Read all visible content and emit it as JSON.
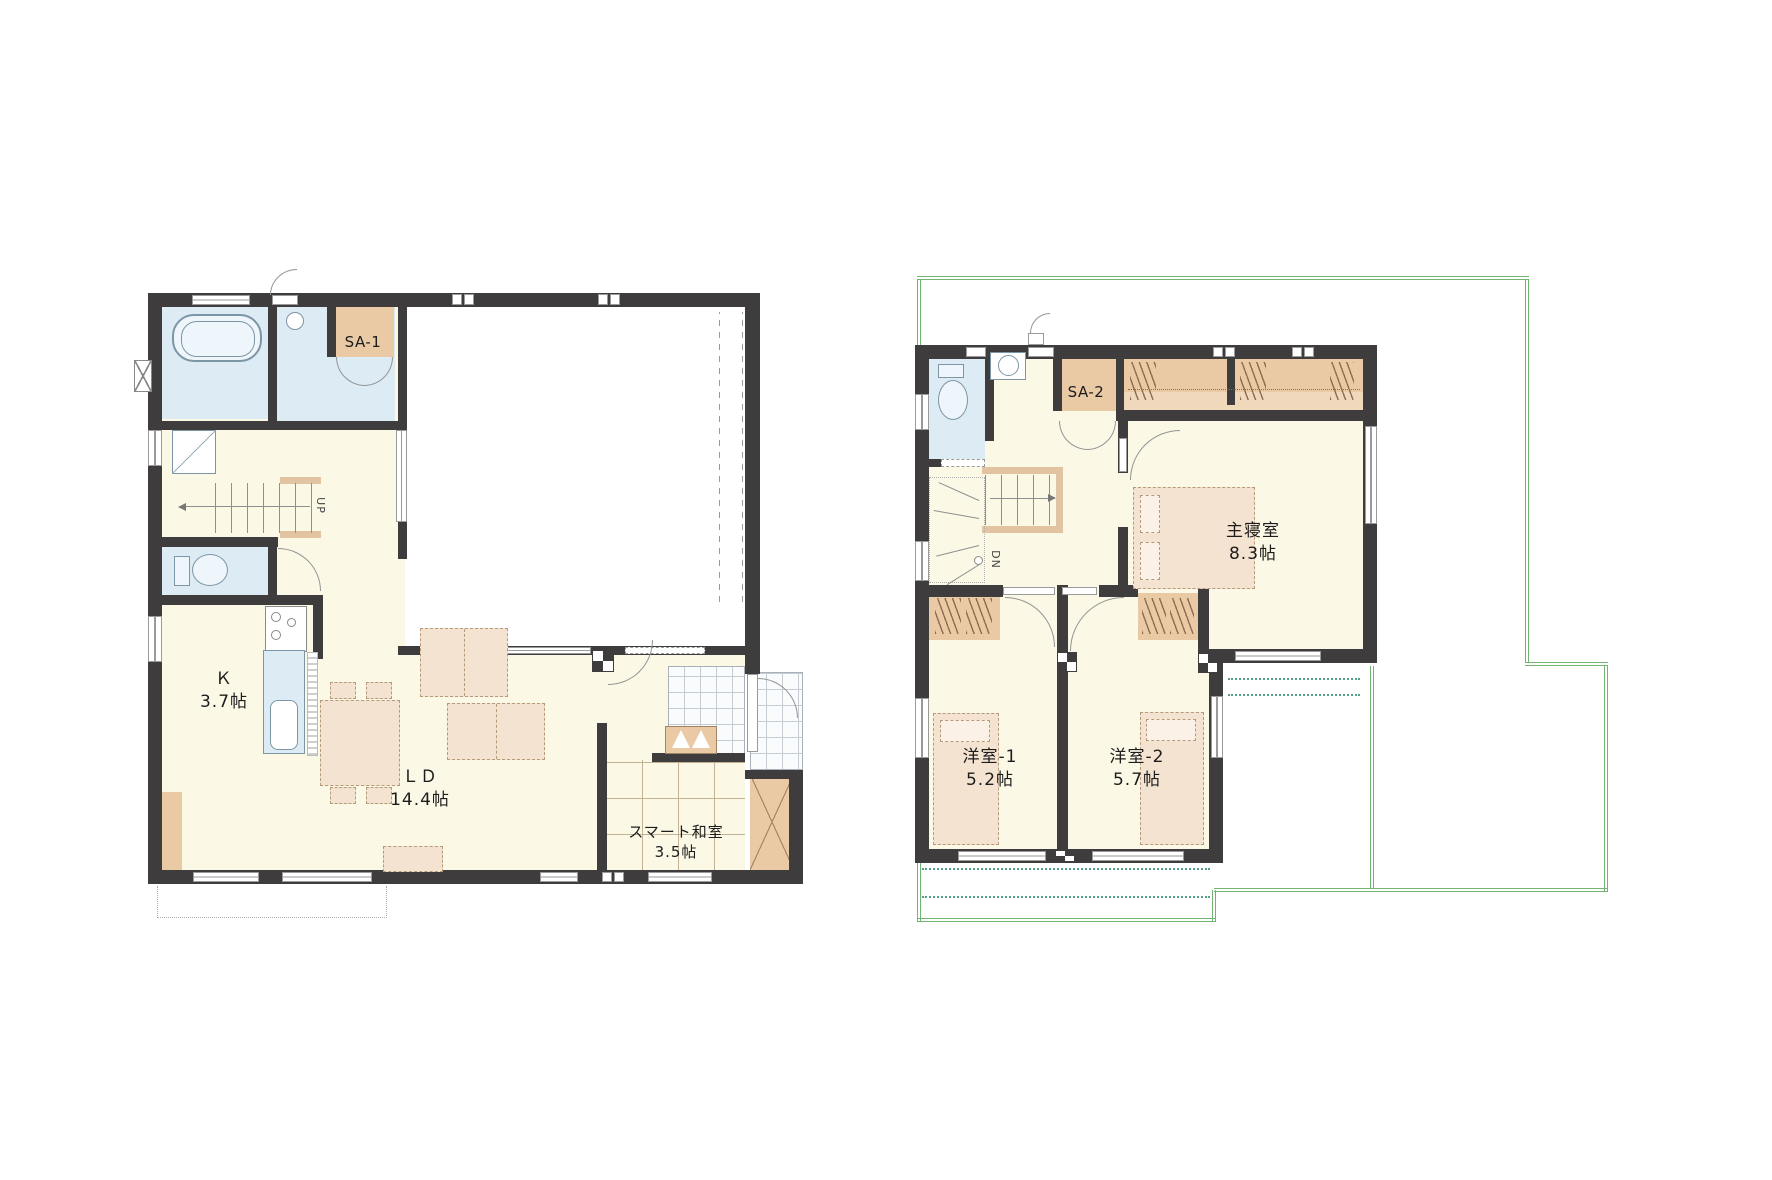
{
  "title": "2-story house floor plan",
  "colors": {
    "wall": "#3e3c3d",
    "floor_cream": "#fbf8e6",
    "wet_area_blue": "#dcebf4",
    "closet_tan": "#eac9a5",
    "furniture_tan": "#f4e3d0",
    "stair_tan": "#e2c3a2",
    "roof_outline_green": "#70b670",
    "eaves_dotted_teal": "#55a18e"
  },
  "floor1": {
    "rooms": {
      "sa1": {
        "label": "SA-1"
      },
      "kitchen": {
        "label": "Ｋ",
        "size": "3.7帖"
      },
      "living_dining": {
        "label": "ＬＤ",
        "size": "14.4帖"
      },
      "smart_washitsu": {
        "label": "スマート和室",
        "size": "3.5帖"
      }
    },
    "stairs": {
      "direction_label": "UP"
    }
  },
  "floor2": {
    "rooms": {
      "sa2": {
        "label": "SA-2"
      },
      "master_bedroom": {
        "label": "主寝室",
        "size": "8.3帖"
      },
      "western_room_1": {
        "label": "洋室-1",
        "size": "5.2帖"
      },
      "western_room_2": {
        "label": "洋室-2",
        "size": "5.7帖"
      }
    },
    "stairs": {
      "direction_label": "DN"
    }
  }
}
